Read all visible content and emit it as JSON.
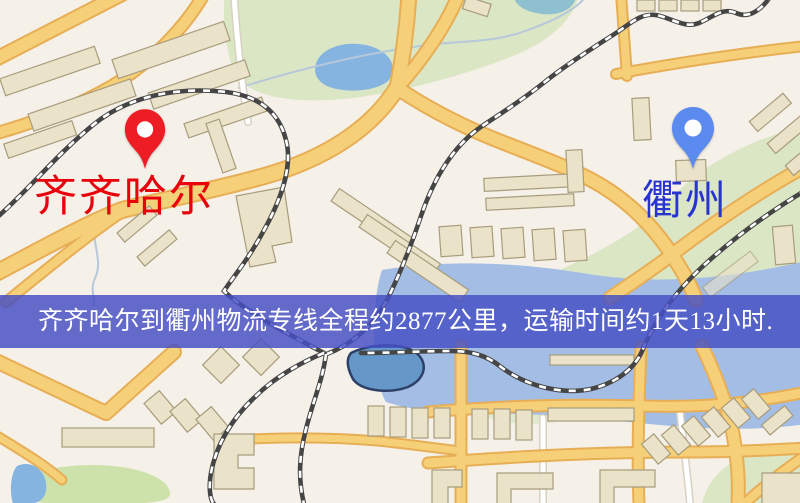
{
  "page": {
    "title": "齐齐哈尔到衢州物流专线地图",
    "width": 800,
    "height": 503
  },
  "map": {
    "type": "stylized-city-map",
    "colors": {
      "background": "#f5f0e8",
      "park": "#dbe6c5",
      "park_bright": "#cde2ab",
      "water": "#86b4e0",
      "water_teal": "#8fc0cf",
      "river": "#a3bde4",
      "pond_dark": "#6598c9",
      "road_fill": "#f6d078",
      "road_casing": "#e7ae55",
      "minor_road": "#ffffff",
      "minor_road_casing": "#d8d2c2",
      "railway": "#454545",
      "railway_dash": "#ffffff",
      "building": "#eae2c9",
      "stream": "#b6c8da"
    }
  },
  "route": {
    "origin": "齐齐哈尔",
    "destination": "衢州",
    "distance": "约2877公里",
    "duration": "约1天13小时"
  },
  "markers": {
    "origin": {
      "label": "齐齐哈尔",
      "pin_color": "#ee1c25",
      "label_color": "#e8000b"
    },
    "destination": {
      "label": "衢州",
      "pin_color": "#5b8bef",
      "label_color": "#2734cf"
    }
  },
  "banner": {
    "text": "齐齐哈尔到衢州物流专线全程约2877公里，运输时间约1天13小时.",
    "background": "#4650c3",
    "text_color": "#ffffff"
  }
}
